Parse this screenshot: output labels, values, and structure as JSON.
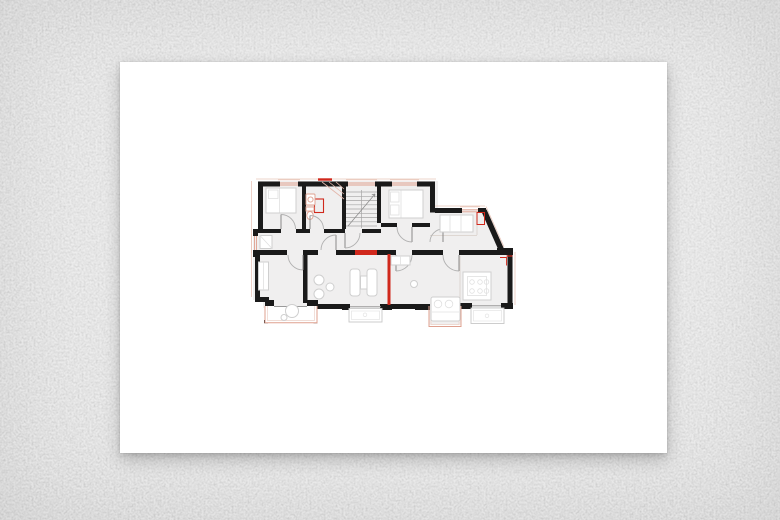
{
  "scene": {
    "type": "architectural-floor-plan-on-wall",
    "description": "White sheet of paper with a black, salmon and red apartment floor plan, mounted on a rough light-gray plaster wall",
    "text_labels": []
  },
  "colors": {
    "wall_bg": "#eaeaea",
    "paper": "#ffffff",
    "plan_wall": "#1a1a1a",
    "new_wall_red": "#d0281c",
    "window_salmon": "#dfa08f",
    "outline_salmon": "#e9c6ba",
    "furniture_outline": "#cfcfcf",
    "room_fill": "#f0efef",
    "door_arc": "#b0b0b0",
    "stair_line": "#a5a5a5",
    "balcony_outline": "#c8c8c8"
  },
  "elements": [
    "exterior-walls",
    "interior-walls",
    "new-walls-red",
    "windows",
    "door-swings",
    "staircase",
    "furniture",
    "bathroom-fixtures",
    "bay-windows",
    "balconies"
  ]
}
